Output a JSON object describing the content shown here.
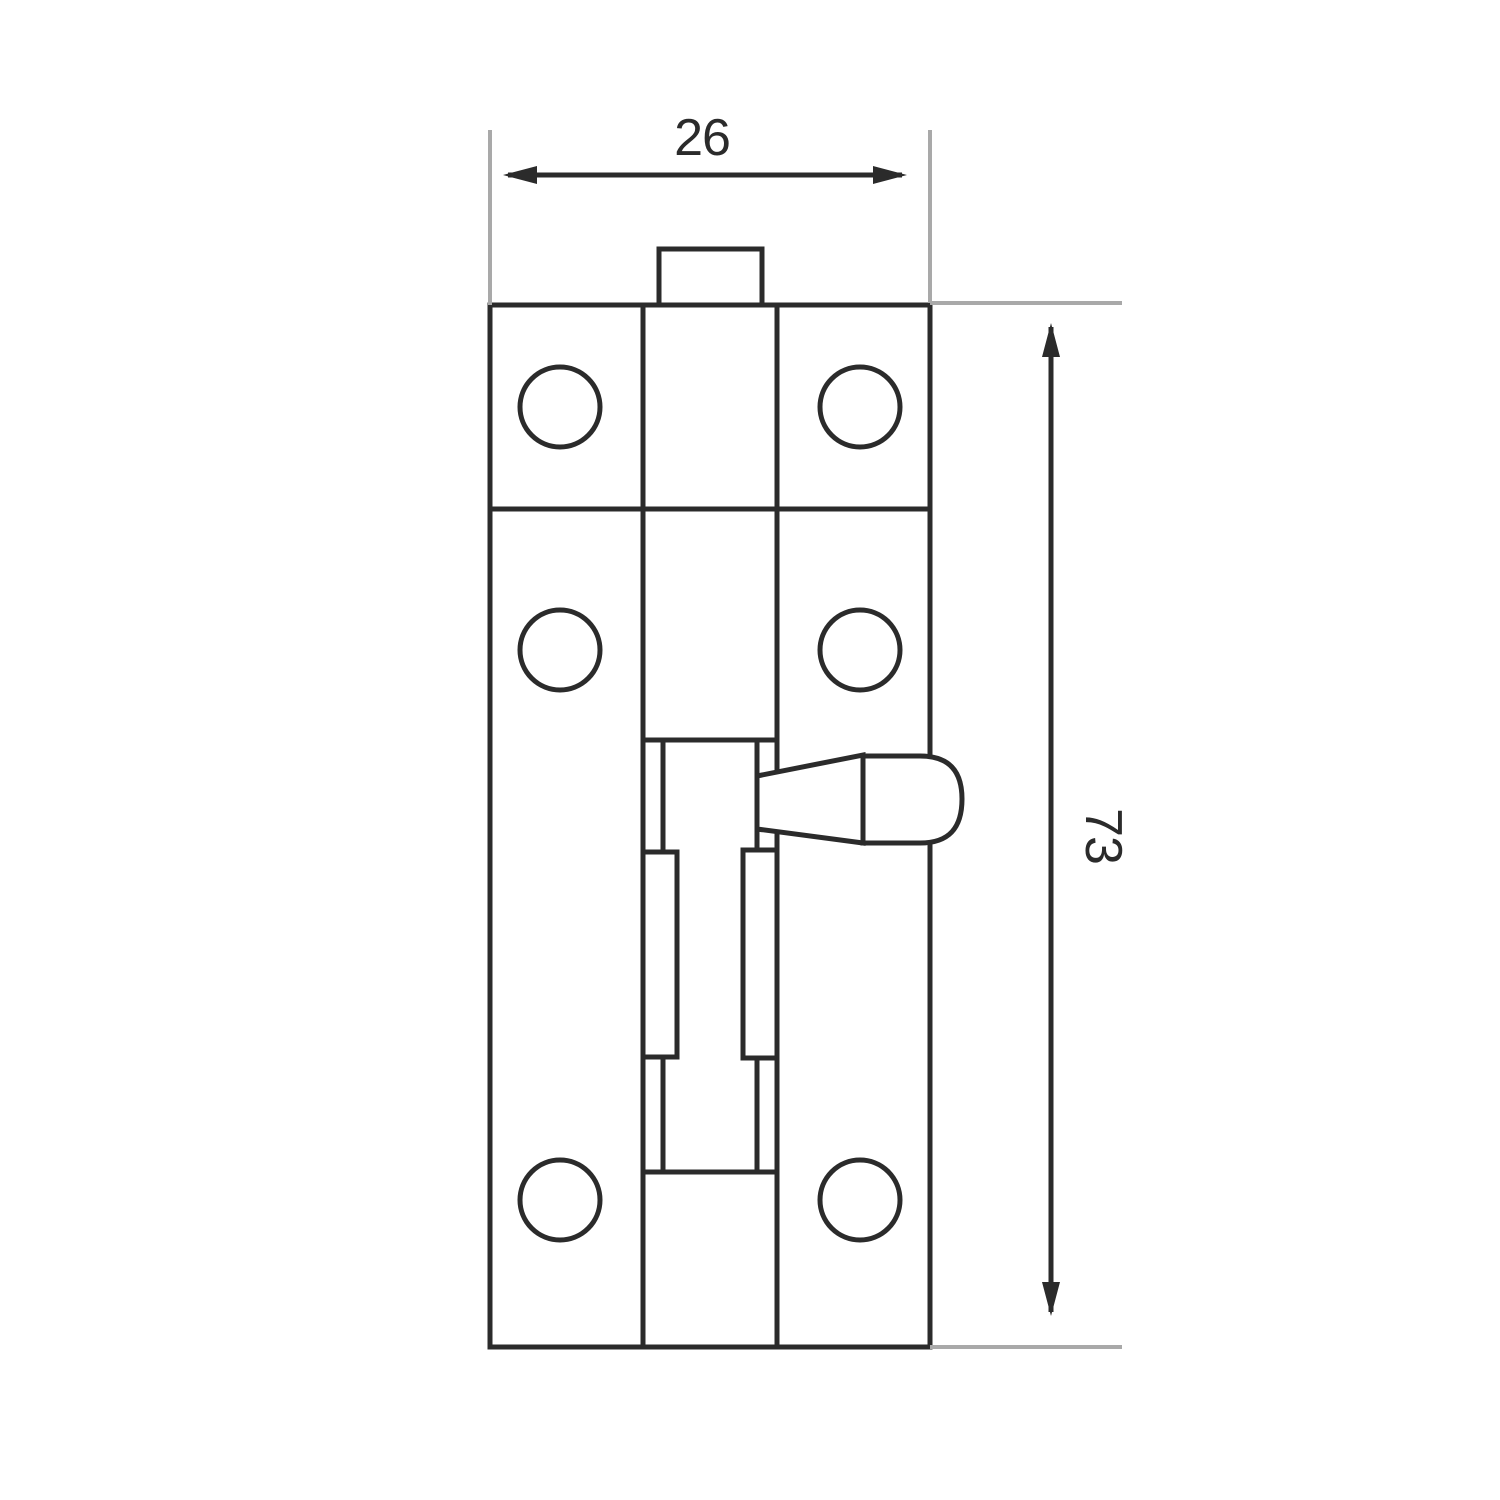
{
  "drawing": {
    "kind": "technical-dimension-drawing",
    "dim_width": {
      "value": "26"
    },
    "dim_height": {
      "value": "73"
    },
    "colors": {
      "line": "#2b2b2b",
      "extension": "#a9a9a9",
      "background": "#ffffff"
    }
  }
}
